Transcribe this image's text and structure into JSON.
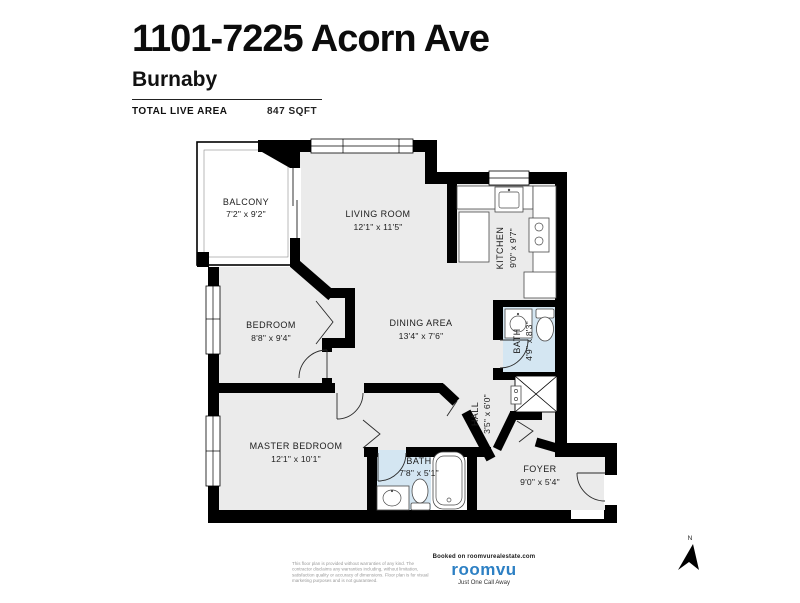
{
  "header": {
    "title": "1101-7225 Acorn Ave",
    "city": "Burnaby",
    "area_label": "TOTAL LIVE AREA",
    "area_value": "847 SQFT"
  },
  "rooms": {
    "balcony": {
      "name": "BALCONY",
      "dims": "7'2\" x 9'2\""
    },
    "living_room": {
      "name": "LIVING ROOM",
      "dims": "12'1\" x 11'5\""
    },
    "kitchen": {
      "name": "KITCHEN",
      "dims": "9'0\" x 9'7\""
    },
    "bedroom": {
      "name": "BEDROOM",
      "dims": "8'8\" x 9'4\""
    },
    "dining_area": {
      "name": "DINING AREA",
      "dims": "13'4\" x 7'6\""
    },
    "bath_upper": {
      "name": "BATH",
      "dims": "4'9\" x 8'3\""
    },
    "hall": {
      "name": "HALL",
      "dims": "3'5\" x 6'0\""
    },
    "master_bedroom": {
      "name": "MASTER BEDROOM",
      "dims": "12'1\" x 10'1\""
    },
    "bath_lower": {
      "name": "BATH",
      "dims": "7'8\" x 5'1\""
    },
    "foyer": {
      "name": "FOYER",
      "dims": "9'0\" x 5'4\""
    }
  },
  "compass": {
    "label": "N"
  },
  "footer": {
    "disclaimer": "This floor plan is provided without warranties of any kind. The contractor disclaims any warranties including, without limitation, satisfaction quality or accuracy of dimensions. Floor plan is for visual marketing purposes and is not guaranteed.",
    "branding_pre": "Booked on roomvurealestate.com",
    "brand": "roomvu",
    "tagline": "Just One Call Away"
  },
  "colors": {
    "wall": "#000000",
    "floor": "#ebebeb",
    "bath_floor": "#d4e6f2",
    "brand_blue": "#2d80c4"
  }
}
